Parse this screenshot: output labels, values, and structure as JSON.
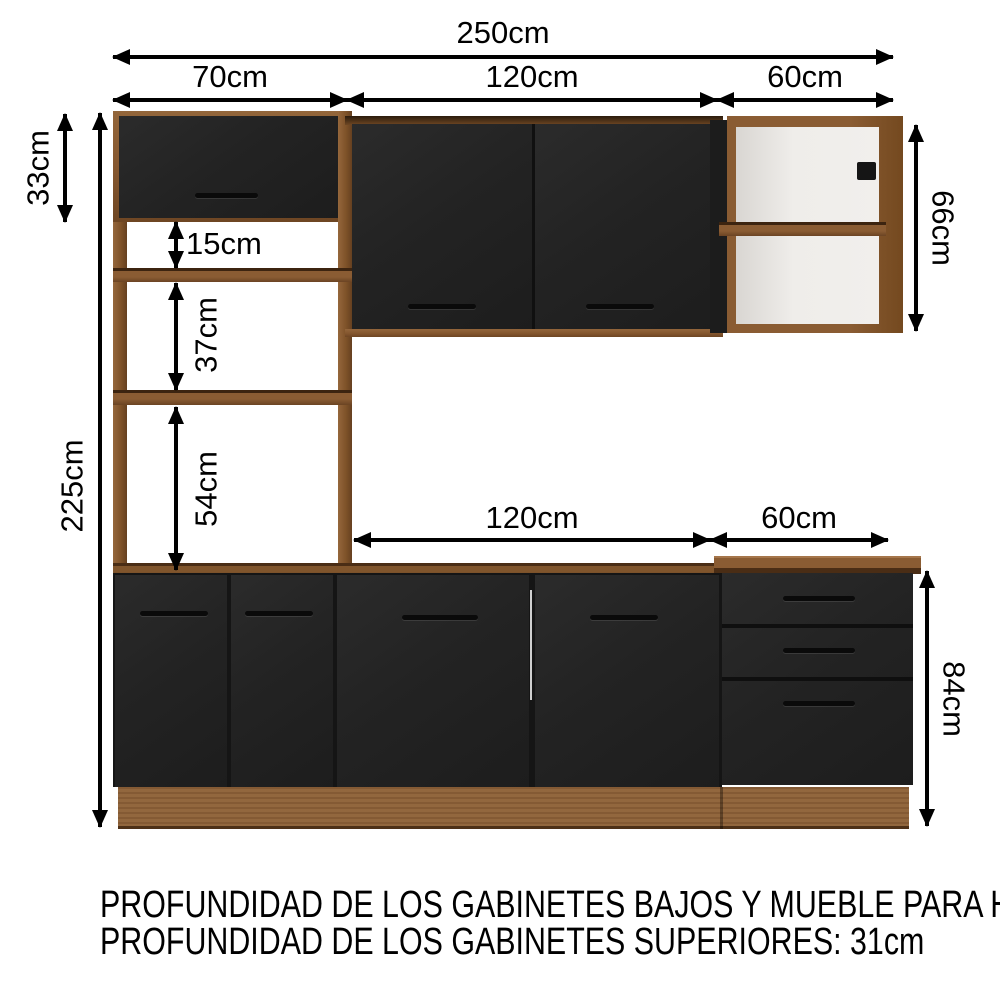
{
  "diagram_title": "kitchen-cabinet-dimension-diagram",
  "dimensions": {
    "total_width": "250cm",
    "left_section_width": "70cm",
    "center_section_width": "120cm",
    "right_section_width": "60cm",
    "tower_top_cabinet_height": "33cm",
    "total_height": "225cm",
    "niche_gap_1": "15cm",
    "niche_gap_2": "37cm",
    "niche_gap_3": "54cm",
    "countertop_center_width": "120cm",
    "countertop_right_width": "60cm",
    "upper_right_cabinet_height": "66cm",
    "base_cabinet_height": "84cm"
  },
  "notes": {
    "line1": "PROFUNDIDAD DE LOS GABINETES BAJOS Y MUEBLE PARA HORNO: 52cm",
    "line2": "PROFUNDIDAD DE LOS GABINETES SUPERIORES: 31cm"
  },
  "colors": {
    "background": "#ffffff",
    "arrow_and_text": "#000000",
    "wood": "#8a5c33",
    "wood_dark_edge": "#4a2d15",
    "door_black": "#232323",
    "handle_black": "#0a0a0a",
    "interior_white": "#efedea"
  }
}
